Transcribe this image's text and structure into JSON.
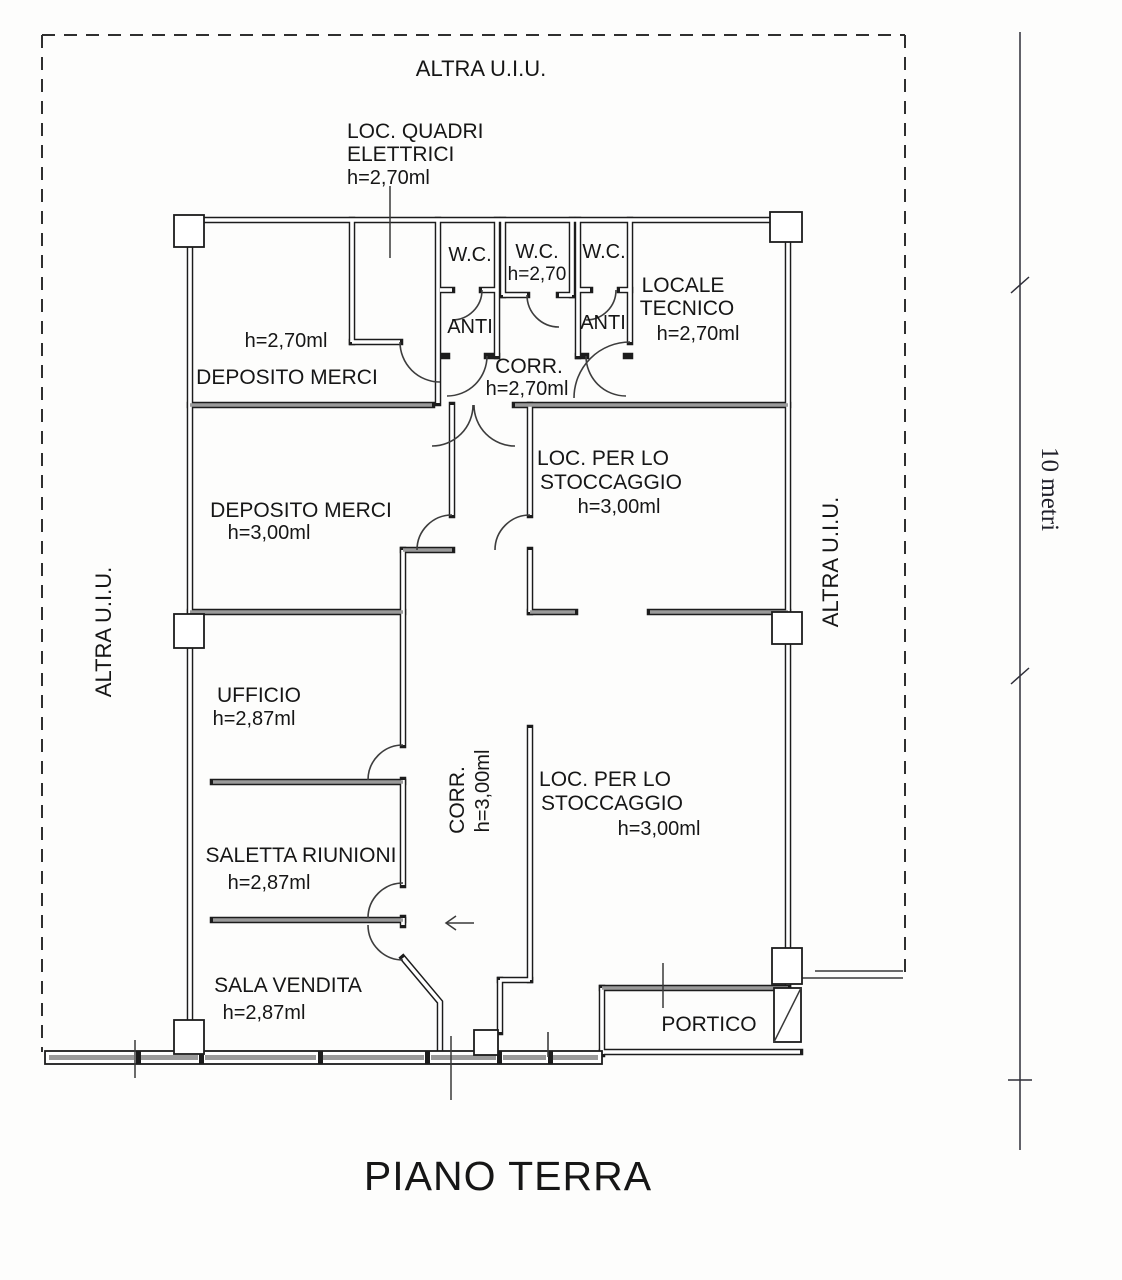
{
  "page": {
    "title": "PIANO TERRA"
  },
  "boundary": {
    "top_label": "ALTRA U.I.U.",
    "left_label": "ALTRA U.I.U.",
    "right_label": "ALTRA U.I.U."
  },
  "dimension": {
    "label": "10 metri"
  },
  "rooms": {
    "loc_quadri": {
      "lines": [
        "LOC. QUADRI",
        "ELETTRICI",
        "h=2,70ml"
      ]
    },
    "deposito_merci_1": {
      "height": "h=2,70ml",
      "name": "DEPOSITO MERCI"
    },
    "wc_left": {
      "name": "W.C."
    },
    "wc_center": {
      "name": "W.C.",
      "height": "h=2,70"
    },
    "wc_right": {
      "name": "W.C."
    },
    "anti_left": {
      "name": "ANTI"
    },
    "anti_right": {
      "name": "ANTI"
    },
    "corridoio_1": {
      "name": "CORR.",
      "height": "h=2,70ml"
    },
    "locale_tecnico": {
      "lines": [
        "LOCALE",
        "TECNICO"
      ],
      "height": "h=2,70ml"
    },
    "deposito_merci_2": {
      "name": "DEPOSITO MERCI",
      "height": "h=3,00ml"
    },
    "stoccaggio_1": {
      "lines": [
        "LOC. PER LO",
        "STOCCAGGIO"
      ],
      "height": "h=3,00ml"
    },
    "ufficio": {
      "name": "UFFICIO",
      "height": "h=2,87ml"
    },
    "corridoio_2": {
      "name": "CORR.",
      "height": "h=3,00ml"
    },
    "stoccaggio_2": {
      "lines": [
        "LOC. PER LO",
        "STOCCAGGIO"
      ],
      "height": "h=3,00ml"
    },
    "saletta_riunioni": {
      "name": "SALETTA RIUNIONI",
      "height": "h=2,87ml"
    },
    "sala_vendita": {
      "name": "SALA VENDITA",
      "height": "h=2,87ml"
    },
    "portico": {
      "name": "PORTICO"
    }
  },
  "colors": {
    "wall": "#1c1c1c",
    "poche": "#9a9a9a",
    "paper": "#fdfdfc"
  }
}
